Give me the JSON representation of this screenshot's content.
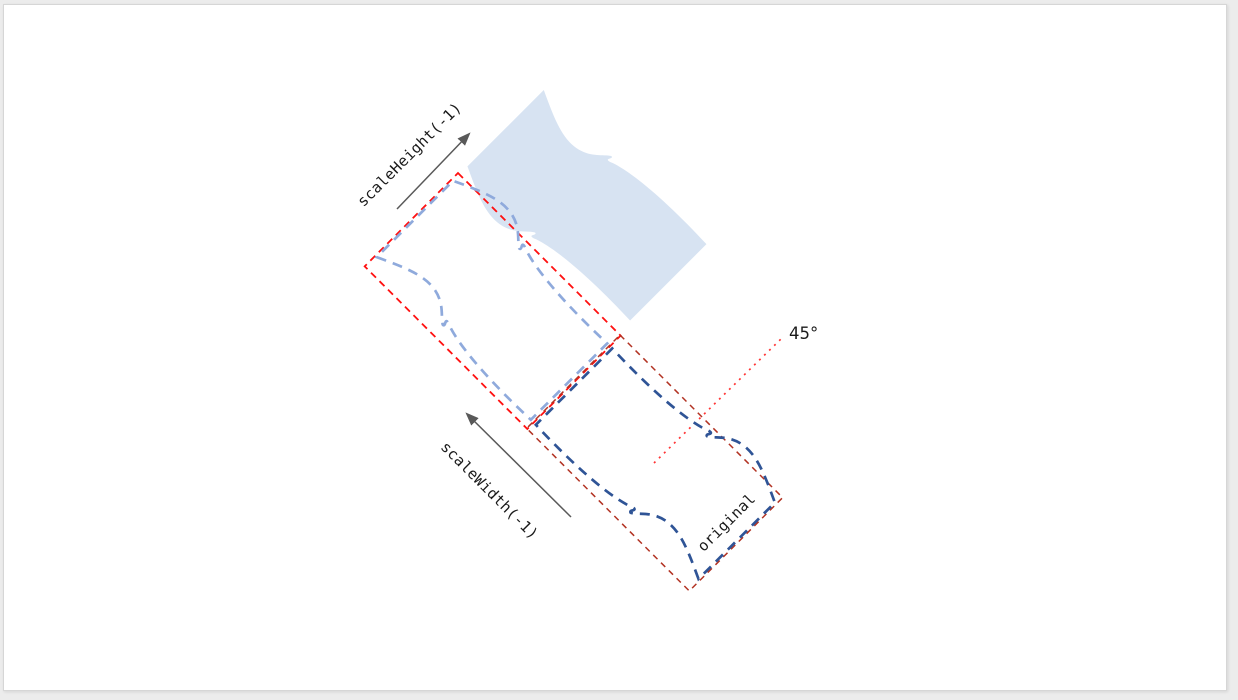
{
  "diagram": {
    "labels": {
      "scale_height": "scaleHeight(-1)",
      "scale_width": "scaleWidth(-1)",
      "original": "original",
      "angle": "45°"
    },
    "colors": {
      "flag_fill": "#D7E3F2",
      "flag_flipped_outline": "#8FAADC",
      "flag_original_outline": "#2F5496",
      "bounds_flipped": "#FF1010",
      "bounds_original": "#B23222",
      "angle_line": "#FF3333",
      "arrow": "#595959",
      "label_text": "#1a1a1a"
    }
  }
}
